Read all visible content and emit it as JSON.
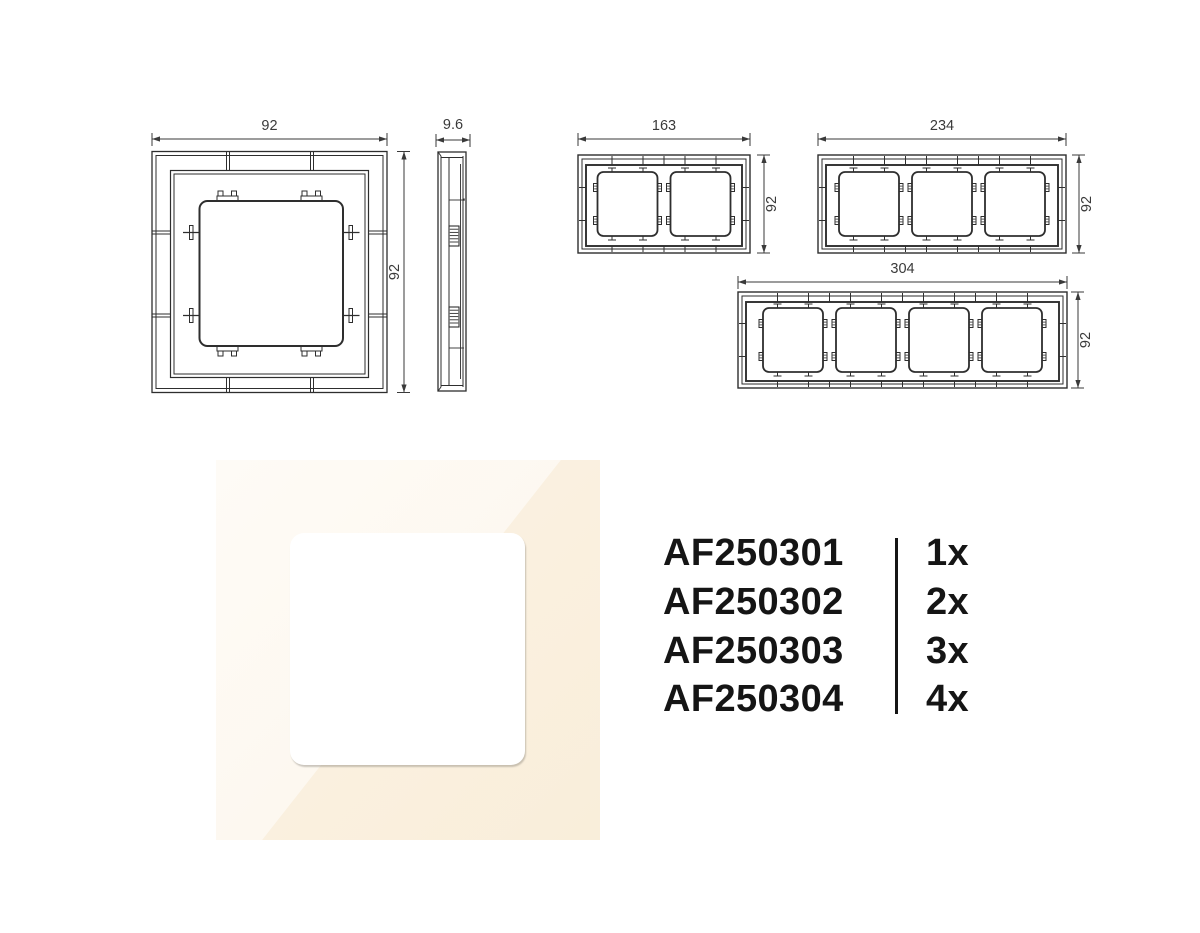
{
  "page": {
    "background": "#ffffff"
  },
  "drawings": {
    "stroke_color": "#2e2e2e",
    "dimension_color": "#3a3a3a",
    "single_front": {
      "title": "1-gang frame front view",
      "width_label": "92",
      "height_label": "92"
    },
    "side_view": {
      "title": "frame side profile view",
      "depth_label": "9.6"
    },
    "two_gang": {
      "title": "2-gang frame front view",
      "width_label": "163",
      "height_label": "92"
    },
    "three_gang": {
      "title": "3-gang frame front view",
      "width_label": "234",
      "height_label": "92"
    },
    "four_gang": {
      "title": "4-gang frame front view",
      "width_label": "304",
      "height_label": "92"
    }
  },
  "photo": {
    "frame_color_light": "#fdf8f0",
    "frame_color_dark": "#f9eeda",
    "window_color": "#ffffff"
  },
  "parts_list": {
    "items": [
      {
        "code": "AF250301",
        "qty": "1x"
      },
      {
        "code": "AF250302",
        "qty": "2x"
      },
      {
        "code": "AF250303",
        "qty": "3x"
      },
      {
        "code": "AF250304",
        "qty": "4x"
      }
    ]
  }
}
